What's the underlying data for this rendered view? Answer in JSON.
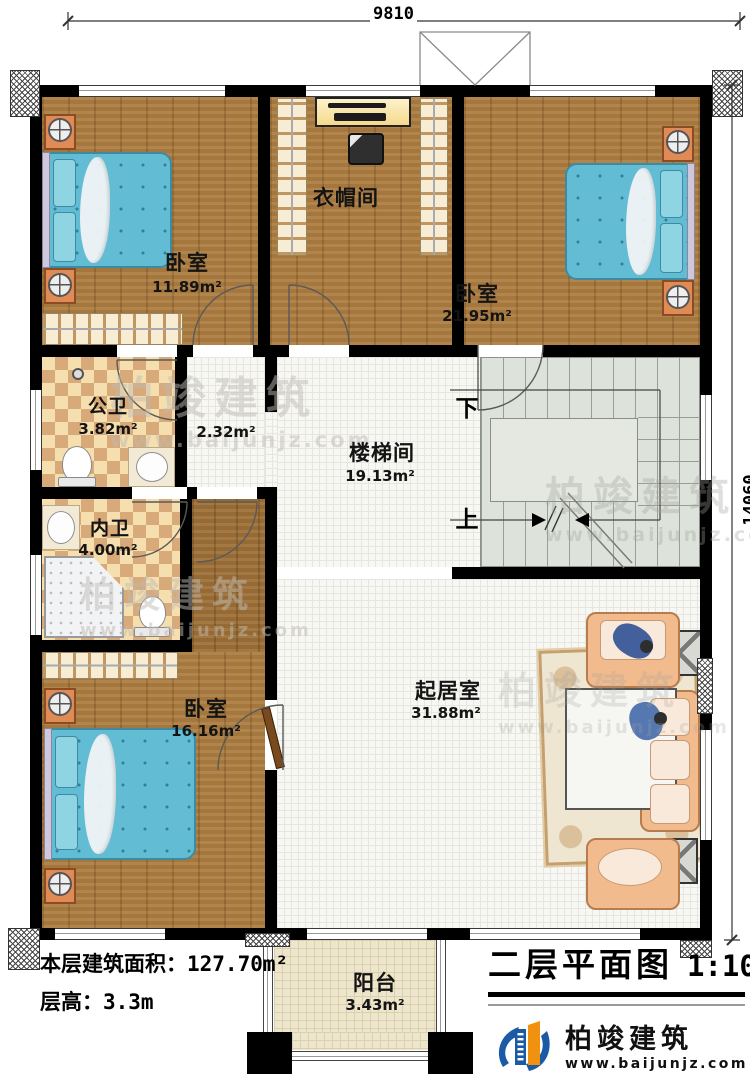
{
  "dimensions": {
    "top": "9810",
    "right": "14060"
  },
  "rooms": [
    {
      "name": "卧室",
      "area": "11.89m²"
    },
    {
      "name": "衣帽间",
      "area": ""
    },
    {
      "name": "卧室",
      "area": "21.95m²"
    },
    {
      "name": "公卫",
      "area": "3.82m²"
    },
    {
      "name": "",
      "area": "2.32m²"
    },
    {
      "name": "内卫",
      "area": "4.00m²"
    },
    {
      "name": "楼梯间",
      "area": "19.13m²"
    },
    {
      "name": "卧室",
      "area": "16.16m²"
    },
    {
      "name": "起居室",
      "area": "31.88m²"
    },
    {
      "name": "阳台",
      "area": "3.43m²"
    }
  ],
  "stairs": {
    "down_label": "下",
    "up_label": "上"
  },
  "footer": {
    "area_label": "本层建筑面积：",
    "area_value": "127.70m²",
    "height_label": "层高：",
    "height_value": "3.3m"
  },
  "titleblock": {
    "title": "二层平面图",
    "scale": "1:100"
  },
  "brand": {
    "name": "柏竣建筑",
    "url": "www.baijunjz.com"
  },
  "watermark": {
    "name": "柏竣建筑",
    "url": "www.baijunjz.com"
  },
  "colors": {
    "wall": "#000000",
    "wood": "#ad7d41",
    "checker_light": "#f6dfae",
    "checker_dark": "#d8a979",
    "tile": "#f7f7f4",
    "stair": "#dde2da",
    "balcony_tile": "#ede6cd",
    "bed": "#62bcd4",
    "sofa": "#f2bb8e",
    "brand_blue": "#1b5aa5",
    "brand_orange": "#f0920f"
  }
}
